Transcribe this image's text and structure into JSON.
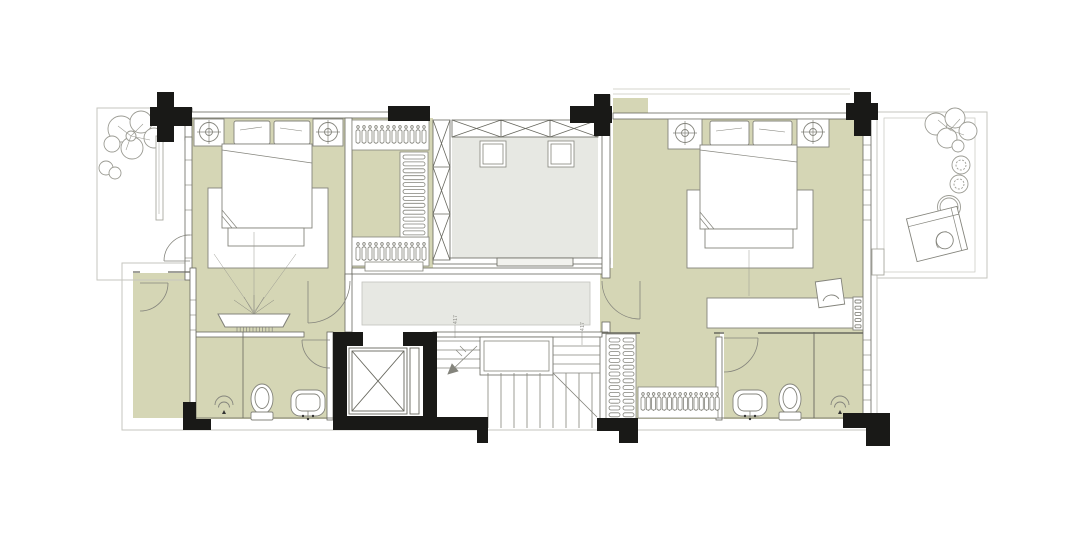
{
  "document": {
    "kind": "residential-floor-plan-drawing",
    "annotations": {
      "dim_left": "417",
      "dim_right": "417"
    }
  },
  "colors": {
    "background": "#ffffff",
    "floor_olive": "#d5d6b5",
    "floor_gray": "#e7e8e3",
    "wall_line": "#68685f",
    "furniture_line": "#84847c",
    "outline_light": "#c6c6bf",
    "structure_black": "#191917"
  },
  "symbols": [
    "bed",
    "pillow",
    "nightstand",
    "table-lamp",
    "rug",
    "bench",
    "wardrobe-hanger-rack",
    "shelf-stack",
    "elevator-shaft",
    "staircase",
    "toilet",
    "washbasin",
    "shower-head",
    "vanity-dresser",
    "desk",
    "desk-chair",
    "lounge-chair",
    "side-table",
    "tree",
    "shrub",
    "column",
    "door-swing",
    "window"
  ]
}
